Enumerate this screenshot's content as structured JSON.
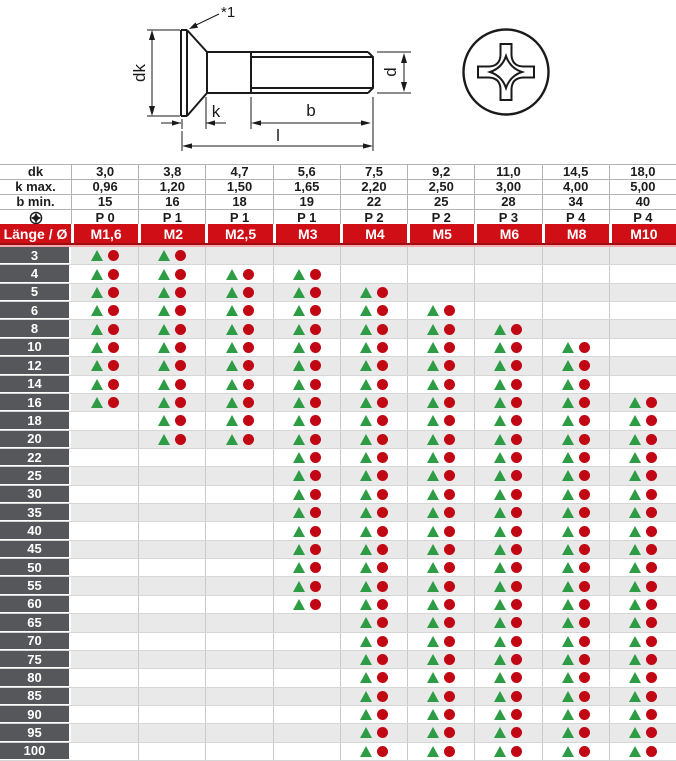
{
  "drawing": {
    "note_label": "*1",
    "labels": {
      "dk": "dk",
      "k": "k",
      "b": "b",
      "l": "l",
      "d": "d"
    }
  },
  "table": {
    "spec_rows": [
      {
        "label": "dk",
        "icon": "",
        "values": [
          "3,0",
          "3,8",
          "4,7",
          "5,6",
          "7,5",
          "9,2",
          "11,0",
          "14,5",
          "18,0"
        ]
      },
      {
        "label": "k max.",
        "icon": "",
        "values": [
          "0,96",
          "1,20",
          "1,50",
          "1,65",
          "2,20",
          "2,50",
          "3,00",
          "4,00",
          "5,00"
        ]
      },
      {
        "label": "b min.",
        "icon": "",
        "values": [
          "15",
          "16",
          "18",
          "19",
          "22",
          "25",
          "28",
          "34",
          "40"
        ]
      },
      {
        "label": "",
        "icon": "phillips-drive",
        "values": [
          "P 0",
          "P 1",
          "P 1",
          "P 1",
          "P 2",
          "P 2",
          "P 3",
          "P 4",
          "P 4"
        ]
      }
    ],
    "header": {
      "corner": "Länge / Ø",
      "columns": [
        "M1,6",
        "M2",
        "M2,5",
        "M3",
        "M4",
        "M5",
        "M6",
        "M8",
        "M10"
      ]
    },
    "rows": [
      {
        "length": "3",
        "cells": [
          1,
          1,
          0,
          0,
          0,
          0,
          0,
          0,
          0
        ]
      },
      {
        "length": "4",
        "cells": [
          1,
          1,
          1,
          1,
          0,
          0,
          0,
          0,
          0
        ]
      },
      {
        "length": "5",
        "cells": [
          1,
          1,
          1,
          1,
          1,
          0,
          0,
          0,
          0
        ]
      },
      {
        "length": "6",
        "cells": [
          1,
          1,
          1,
          1,
          1,
          1,
          0,
          0,
          0
        ]
      },
      {
        "length": "8",
        "cells": [
          1,
          1,
          1,
          1,
          1,
          1,
          1,
          0,
          0
        ]
      },
      {
        "length": "10",
        "cells": [
          1,
          1,
          1,
          1,
          1,
          1,
          1,
          1,
          0
        ]
      },
      {
        "length": "12",
        "cells": [
          1,
          1,
          1,
          1,
          1,
          1,
          1,
          1,
          0
        ]
      },
      {
        "length": "14",
        "cells": [
          1,
          1,
          1,
          1,
          1,
          1,
          1,
          1,
          0
        ]
      },
      {
        "length": "16",
        "cells": [
          1,
          1,
          1,
          1,
          1,
          1,
          1,
          1,
          1
        ]
      },
      {
        "length": "18",
        "cells": [
          0,
          1,
          1,
          1,
          1,
          1,
          1,
          1,
          1
        ]
      },
      {
        "length": "20",
        "cells": [
          0,
          1,
          1,
          1,
          1,
          1,
          1,
          1,
          1
        ]
      },
      {
        "length": "22",
        "cells": [
          0,
          0,
          0,
          1,
          1,
          1,
          1,
          1,
          1
        ]
      },
      {
        "length": "25",
        "cells": [
          0,
          0,
          0,
          1,
          1,
          1,
          1,
          1,
          1
        ]
      },
      {
        "length": "30",
        "cells": [
          0,
          0,
          0,
          1,
          1,
          1,
          1,
          1,
          1
        ]
      },
      {
        "length": "35",
        "cells": [
          0,
          0,
          0,
          1,
          1,
          1,
          1,
          1,
          1
        ]
      },
      {
        "length": "40",
        "cells": [
          0,
          0,
          0,
          1,
          1,
          1,
          1,
          1,
          1
        ]
      },
      {
        "length": "45",
        "cells": [
          0,
          0,
          0,
          1,
          1,
          1,
          1,
          1,
          1
        ]
      },
      {
        "length": "50",
        "cells": [
          0,
          0,
          0,
          1,
          1,
          1,
          1,
          1,
          1
        ]
      },
      {
        "length": "55",
        "cells": [
          0,
          0,
          0,
          1,
          1,
          1,
          1,
          1,
          1
        ]
      },
      {
        "length": "60",
        "cells": [
          0,
          0,
          0,
          1,
          1,
          1,
          1,
          1,
          1
        ]
      },
      {
        "length": "65",
        "cells": [
          0,
          0,
          0,
          0,
          1,
          1,
          1,
          1,
          1
        ]
      },
      {
        "length": "70",
        "cells": [
          0,
          0,
          0,
          0,
          1,
          1,
          1,
          1,
          1
        ]
      },
      {
        "length": "75",
        "cells": [
          0,
          0,
          0,
          0,
          1,
          1,
          1,
          1,
          1
        ]
      },
      {
        "length": "80",
        "cells": [
          0,
          0,
          0,
          0,
          1,
          1,
          1,
          1,
          1
        ]
      },
      {
        "length": "85",
        "cells": [
          0,
          0,
          0,
          0,
          1,
          1,
          1,
          1,
          1
        ]
      },
      {
        "length": "90",
        "cells": [
          0,
          0,
          0,
          0,
          1,
          1,
          1,
          1,
          1
        ]
      },
      {
        "length": "95",
        "cells": [
          0,
          0,
          0,
          0,
          1,
          1,
          1,
          1,
          1
        ]
      },
      {
        "length": "100",
        "cells": [
          0,
          0,
          0,
          0,
          1,
          1,
          1,
          1,
          1
        ]
      }
    ],
    "colors": {
      "header_red": "#cf0e16",
      "label_gray": "#56575a",
      "stripe_gray": "#e9e9e9",
      "triangle_green": "#2d9c44",
      "dot_red": "#c10713",
      "pink_line": "#f3a9ac"
    }
  }
}
